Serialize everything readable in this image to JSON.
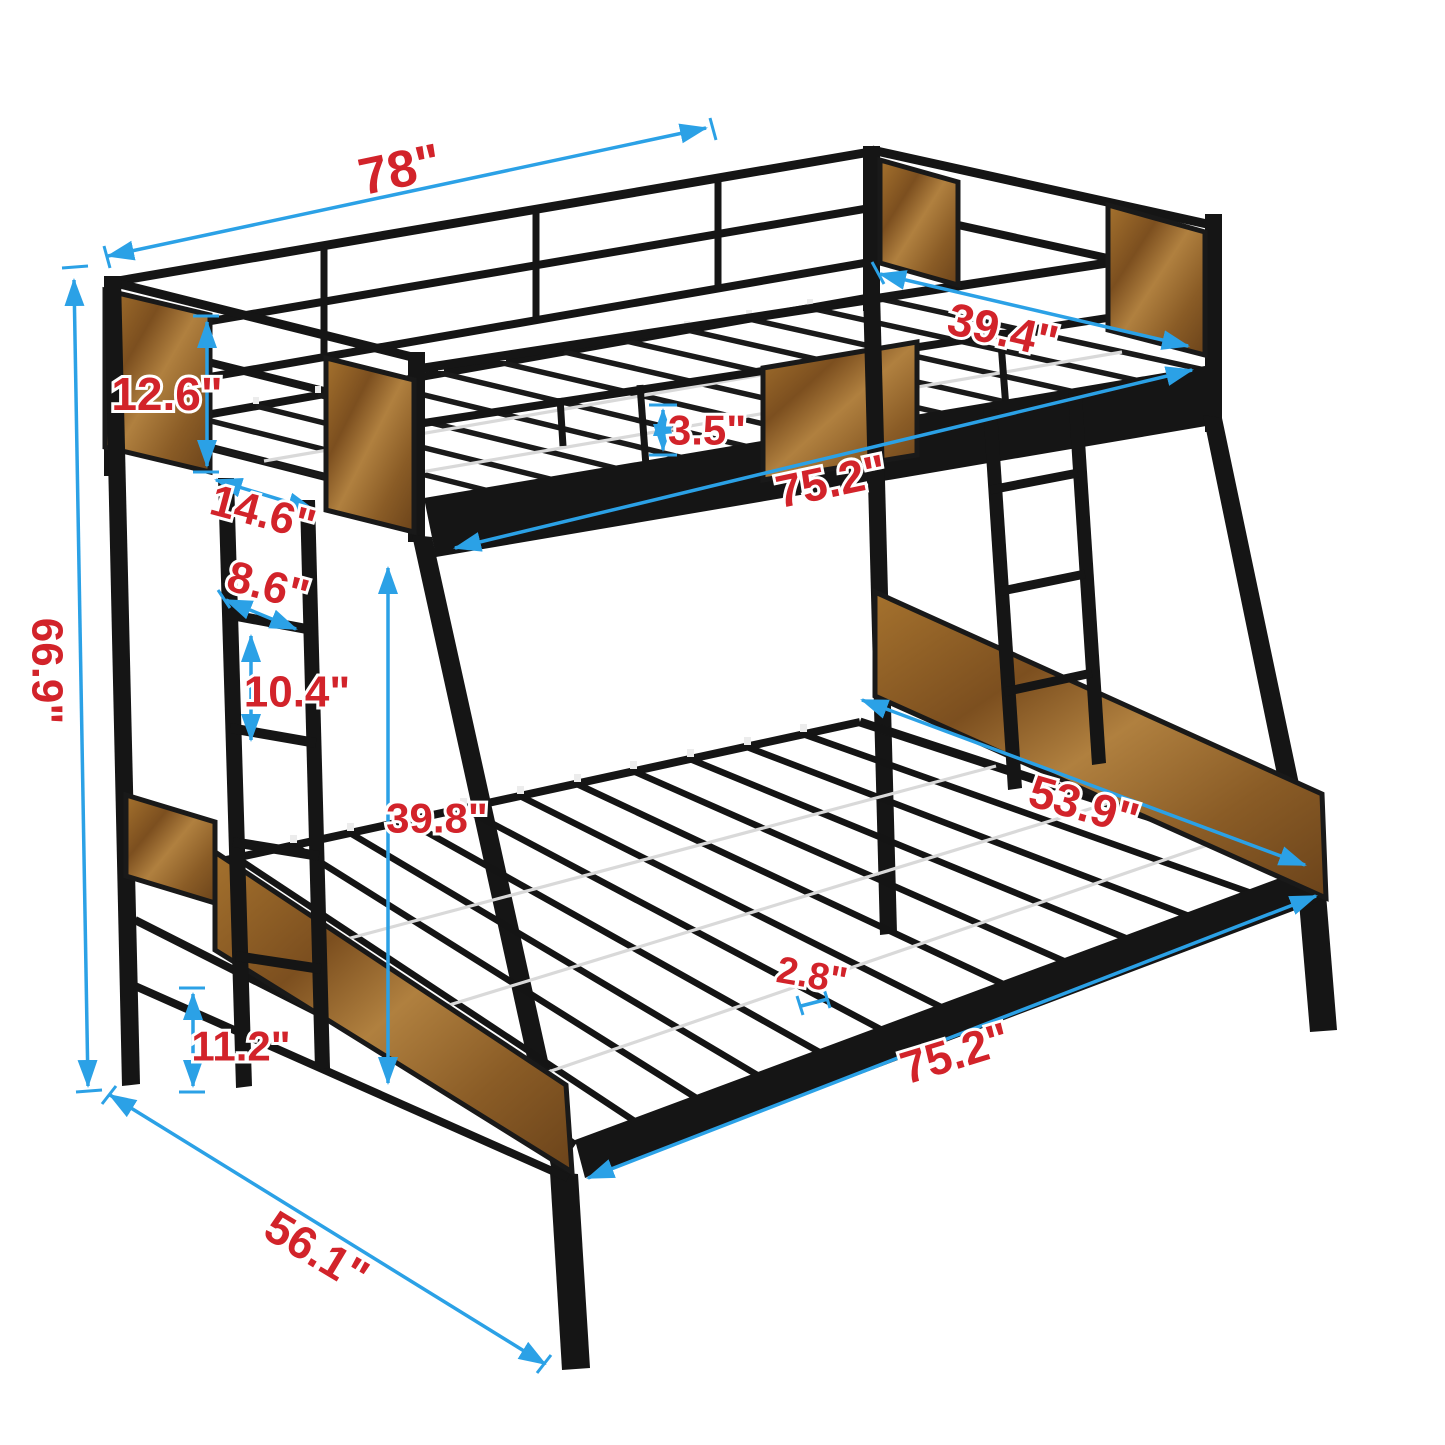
{
  "diagram": {
    "subject": "twin-over-full metal bunk bed with wood panels",
    "colors": {
      "background": "#ffffff",
      "frame": "#151515",
      "wood": "#9a6a38",
      "dimension_arrow": "#2ba1e6",
      "dimension_label": "#d2232a",
      "slat_wire": "#d9d9d9"
    },
    "dimensions": {
      "overall_length": "78\"",
      "upper_bed_width": "39.4\"",
      "headboard_panel_height": "12.6\"",
      "guardrail_rail_gap": "3.5\"",
      "upper_sleeping_length": "75.2\"",
      "headboard_to_ladder": "14.6\"",
      "ladder_width": "8.6\"",
      "ladder_rung_spacing": "10.4\"",
      "overall_height": "66.9\"",
      "bunk_clearance_height": "39.8\"",
      "lower_bed_width": "53.9\"",
      "slat_spacing": "2.8\"",
      "lower_deck_height": "11.2\"",
      "lower_sleeping_length": "75.2\"",
      "overall_depth": "56.1\""
    }
  }
}
